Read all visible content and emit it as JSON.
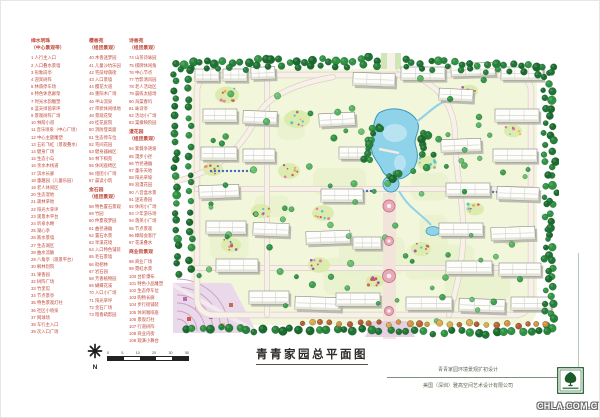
{
  "page": {
    "title": "青青家园总平面图",
    "watermark": "CHLA.COM.CN"
  },
  "compass": {
    "label": "N"
  },
  "scalebar": {
    "ticks": [
      "0",
      "5",
      "10",
      "20",
      "30",
      "50"
    ]
  },
  "footer": {
    "line1": "青青家园环境景观扩初设计",
    "line2": "美国（深圳）雅高空间艺术设计有限公司"
  },
  "legend": {
    "text_color": "#c04a3c",
    "columns": [
      {
        "sections": [
          {
            "title": "绿水明珠",
            "subtitle": "（中心景观带）",
            "items": [
              "1 人行主入口",
              "2 入口叠水景墙",
              "3 形象岗亭",
              "4 迎宾树阵",
              "5 林荫停车场",
              "6 特色休息廊架",
              "7 时光水韵雕塑",
              "8 蓝天绿茵草坪",
              "9 景观树阵广场",
              "10 林荫小道",
              "11 音乐喷泉（中心广场）",
              "12 中心主题雕塑",
              "13 五彩飞虹（景观叠水）",
              "14 健身广场",
              "15 生态小岛",
              "16 亲水木栈道",
              "17 滨水长廊",
              "18 童趣园（儿童乐园）",
              "19 老人休闲区",
              "20 生态湿地",
              "21 疏林草地",
              "22 阳光大草坪",
              "23 观景木平台",
              "24 听泉水榭",
              "25 湖心亭",
              "26 跌水景墙",
              "27 生态湖区",
              "28 曲水流觞",
              "29 八角亭（观景平台）",
              "30 枫林别院",
              "31 果香园",
              "32 树阵广场",
              "33 竹里馆",
              "34 节点景亭",
              "35 特色景观灯柱",
              "36 社区小喷泉",
              "37 网球场",
              "38 车行主入口",
              "39 次入口广场"
            ]
          }
        ]
      },
      {
        "sections": [
          {
            "title": "樱香苑",
            "subtitle": "（组团景观）",
            "items": [
              "40 木香迷梦园",
              "41 儿童沙坑乐园",
              "42 宅前绿荫街",
              "43 入口景墙",
              "44 樱花大道",
              "45 重阳木广场",
              "46 半山流泉",
              "47 带状休闲绿地",
              "48 景观花架",
              "49 桂花庭院",
              "50 消防登高面",
              "51 生态停车位",
              "52 宅间花园",
              "53 健身器械区",
              "54 林下棋苑",
              "55 休闲座椅区",
              "56 组团小广场",
              "57 晨读小筑"
            ]
          },
          {
            "title": "金石园",
            "subtitle": "（组团景观）",
            "items": [
              "58 特色置石景观",
              "59 竹园",
              "60 仲夏夜梦园",
              "61 曲径通幽",
              "62 置石水景",
              "63 旱溪花境",
              "64 入口特色铺装",
              "65 毛石景墙",
              "66 枇杷林",
              "67 岩石园",
              "68 芳香植物园",
              "69 蝴蝶花溪",
              "70 入口小广场",
              "71 阳光草坪",
              "72 金石广场",
              "73 暗香疏影园"
            ]
          }
        ]
      },
      {
        "sections": [
          {
            "title": "诗香苑",
            "subtitle": "（组团景观）",
            "items": [
              "74 山茶诗咏园",
              "75 棋牌休闲角",
              "76 中心节点",
              "77 竹影清风园",
              "78 老人活动区",
              "79 晨练太极场",
              "80 海棠春坞",
              "81 咏诗亭",
              "82 活动小广场",
              "83 棠棣映阶园"
            ]
          },
          {
            "title": "漫花园",
            "subtitle": "（组团景观）",
            "items": [
              "84 紫薇争艳坡",
              "85 漫步小径",
              "86 竹径通幽",
              "87 童乐天地",
              "88 阳光草坡",
              "89 浪漫花田",
              "90 八音盒水景",
              "91 迷迭香园",
              "92 休闲小广场",
              "93 少年游乐场",
              "94 落英小广场",
              "95 节点景观",
              "96 樟荫会客厅",
              "97 花溪叠水"
            ]
          },
          {
            "title": "商业街景观",
            "subtitle": "",
            "items": [
              "98 商业广场",
              "99 霓虹水景",
              "100 台阶瀑布",
              "101 特色小品雕塑",
              "102 生态停车位",
              "103 购物长廊",
              "104 步行街铺装",
              "105 休闲咖啡座",
              "106 景观灯柱",
              "107 行道树阵",
              "108 商业内街",
              "109 观演小舞台"
            ]
          }
        ]
      }
    ]
  },
  "map": {
    "colors": {
      "lawn": "#f2f6da",
      "lawn2": "#e9f1cd",
      "road": "#f8f1e9",
      "road_edge": "#dbd0c3",
      "building": "#fdfdfb",
      "building_edge": "#8a8a80",
      "building_shadow": "#b3b3a8",
      "lake": "#8fd3ea",
      "lake_edge": "#3e96bc",
      "lake_light": "#bfe6f3",
      "plaza": "#e9d9ea",
      "axis_strip": "#f2e4da",
      "node_fill": "#e9aab8",
      "node_edge": "#c4728a",
      "tree_outline": "#14532a",
      "logo_green": "#1c5a2a"
    }
  }
}
